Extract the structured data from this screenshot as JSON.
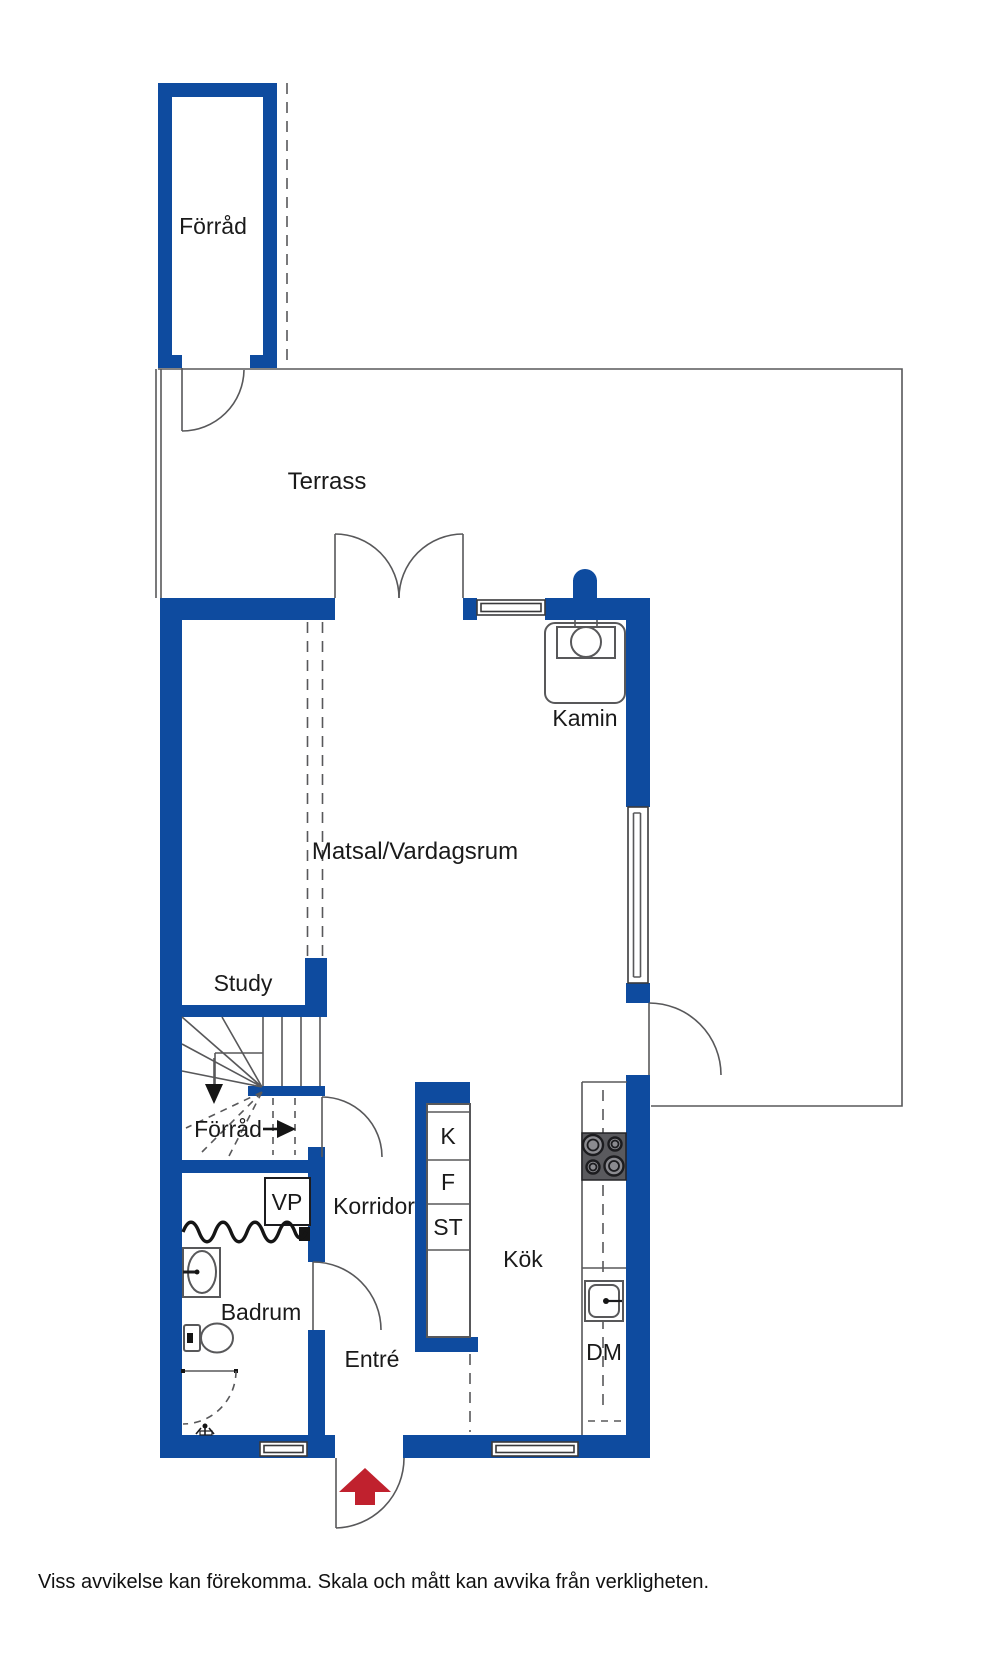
{
  "colors": {
    "wall": "#0e4b9f",
    "line": "#58585a",
    "text": "#1a1a1a",
    "arrow_red": "#c0212e",
    "stove": "#5a5a5e"
  },
  "labels": {
    "storage_top": "Förråd",
    "terrace": "Terrass",
    "fireplace": "Kamin",
    "living_dining": "Matsal/Vardagsrum",
    "study": "Study",
    "storage_under_stairs": "Förråd",
    "corridor": "Korridor",
    "kitchen": "Kök",
    "bathroom": "Badrum",
    "entrance": "Entré",
    "heat_pump": "VP",
    "fridge": "K",
    "freezer": "F",
    "pantry": "ST",
    "dishwasher": "DM"
  },
  "disclaimer": "Viss avvikelse kan förekomma. Skala och mått kan avvika från verkligheten."
}
